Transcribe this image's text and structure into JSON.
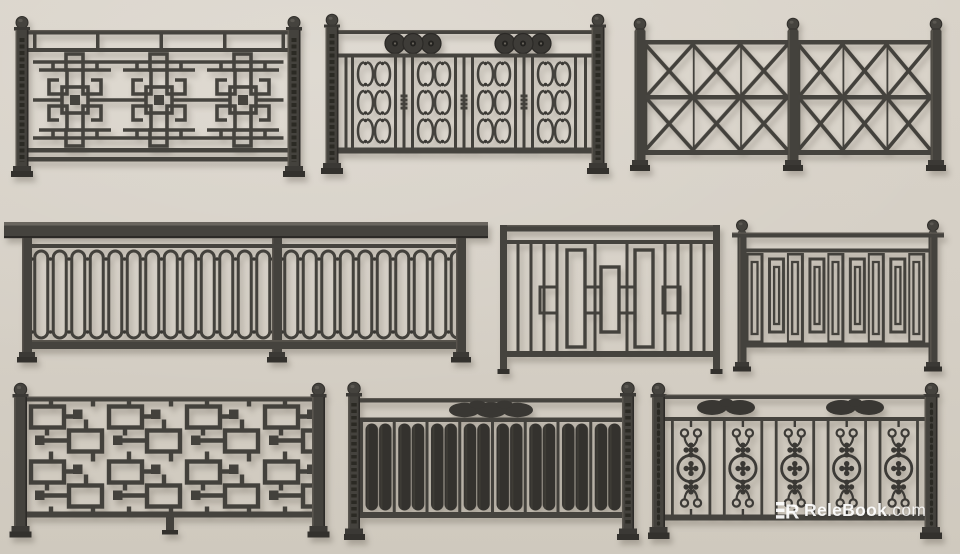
{
  "scene": {
    "description": "Nine dark cast-iron balcony railing 3D models displayed in three rows on a beige plaster wall",
    "wall_color": "#d6d0c6",
    "metal_color": "#43413c",
    "metal_dark": "#34322e",
    "metal_highlight": "#5d5952"
  },
  "watermark": {
    "logo_letter": "R",
    "brand": "ReleBook",
    "suffix": ".com",
    "color": "#ffffff"
  },
  "railings": [
    {
      "id": "r1",
      "row": 1,
      "name": "Chinese lattice railing with ball-finial posts"
    },
    {
      "id": "r2",
      "row": 1,
      "name": "Scrollwork railing with triple-disc frieze"
    },
    {
      "id": "r3",
      "row": 1,
      "name": "Cross-braced X-lattice railing with three posts"
    },
    {
      "id": "r4",
      "row": 2,
      "name": "Long balcony railing with oval loop balusters"
    },
    {
      "id": "r5",
      "row": 2,
      "name": "Staggered rectangle picket railing"
    },
    {
      "id": "r6",
      "row": 2,
      "name": "Nested rectangle picket railing with round posts"
    },
    {
      "id": "r7",
      "row": 3,
      "name": "Chinese fret maze railing with center foot"
    },
    {
      "id": "r8",
      "row": 3,
      "name": "Paddle-slat railing with cloud crest"
    },
    {
      "id": "r9",
      "row": 3,
      "name": "Scroll medallion railing with double cloud crests"
    }
  ]
}
